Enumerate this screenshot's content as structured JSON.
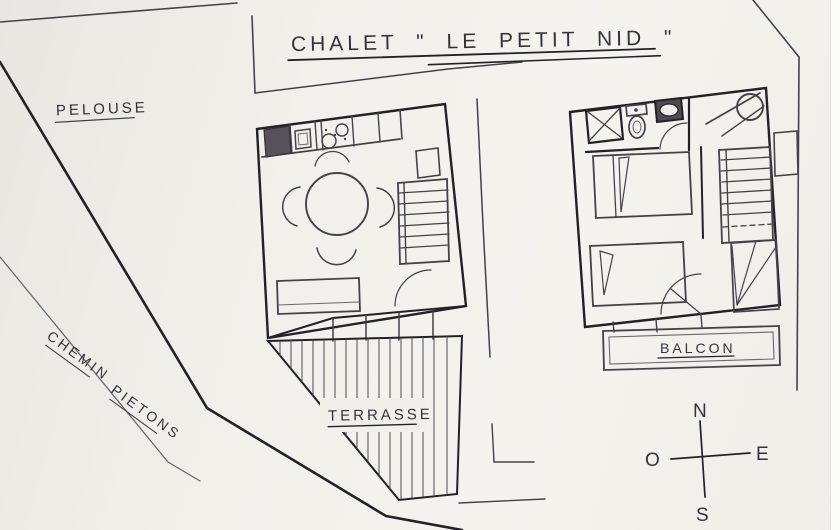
{
  "title": {
    "text": "CHALET \" LE PETIT NID \""
  },
  "areas": {
    "lawn": "PELOUSE",
    "path_word1": "CHEMIN",
    "path_word2": "PIETONS",
    "terrace": "TERRASSE",
    "balcony": "BALCON"
  },
  "compass": {
    "north": "N",
    "south": "S",
    "east": "E",
    "west": "O"
  },
  "colors": {
    "paper": "#f1efe9",
    "ink": "#45404a",
    "ink_dark": "#23202a"
  }
}
